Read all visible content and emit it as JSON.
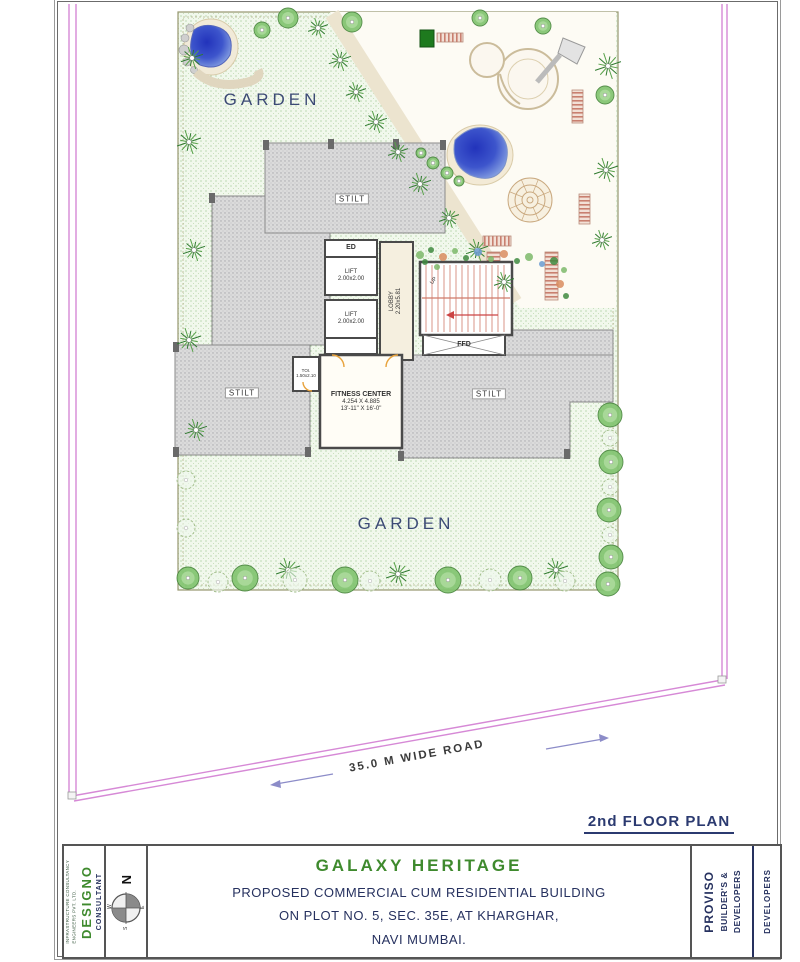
{
  "page": {
    "plan_title": "2nd FLOOR PLAN"
  },
  "plan": {
    "labels": {
      "garden_top": "GARDEN",
      "garden_bottom": "GARDEN",
      "stilt": "STILT",
      "ed": "ED",
      "lift": "LIFT",
      "lift_dim": "2.00x2.00",
      "lobby": "LOBBY",
      "lobby_dim": "2.20x5.81",
      "up": "UP",
      "ffd": "FFD",
      "toi": "TOI.",
      "toi_dim": "1.50x2.10",
      "fitness": "FITNESS CENTER",
      "fitness_dim_m": "4.254 X 4.885",
      "fitness_dim_ft": "13'-11\" X 16'-0\"",
      "road": "35.0 M WIDE ROAD"
    }
  },
  "title_block": {
    "consultant_heading": "CONSULTANT",
    "consultant_name": "DESIGNO",
    "consultant_sub1": "INFRASTRUCTURE CONSULTANCY",
    "consultant_sub2": "ENGINEERS PVT. LTD.",
    "north": {
      "n": "N",
      "w": "W",
      "e": "E",
      "s": "S"
    },
    "project_name": "GALAXY HERITAGE",
    "project_line2": "PROPOSED COMMERCIAL CUM  RESIDENTIAL BUILDING",
    "project_line3": "ON PLOT NO. 5,  SEC. 35E,  AT KHARGHAR,",
    "project_line4": "NAVI MUMBAI.",
    "developer_name1": "PROVISO",
    "developer_name2": "BUILDER'S &",
    "developer_name3": "DEVELOPERS",
    "developer_heading": "DEVELOPERS"
  },
  "colors": {
    "title_green": "#3f8a2e",
    "navy": "#283569",
    "boundary_magenta": "#d689d6",
    "stilt_gray": "#dbdbdb",
    "garden_green": "#f1f8ec",
    "stair_red": "#cf7a6a"
  }
}
